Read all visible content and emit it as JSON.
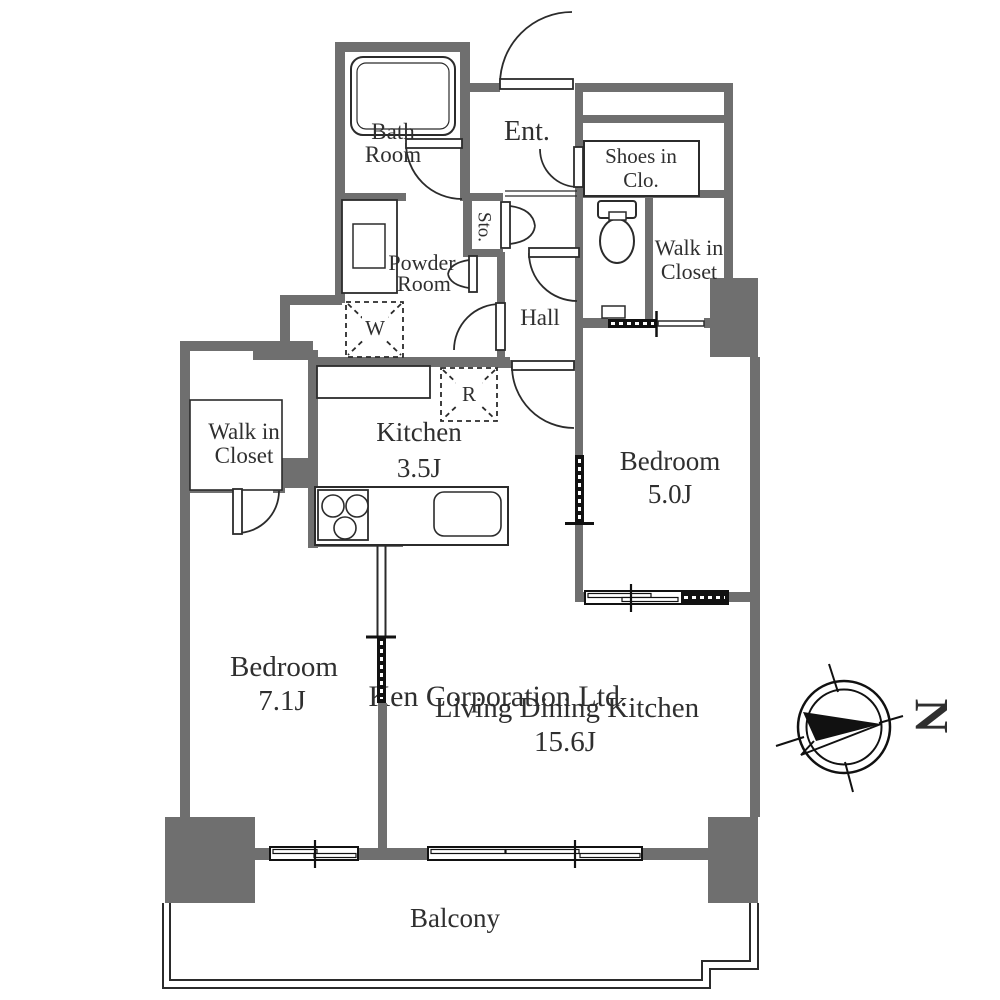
{
  "floorplan": {
    "rooms": {
      "bath": {
        "line1": "Bath",
        "line2": "Room"
      },
      "entrance": {
        "label": "Ent."
      },
      "shoes_closet": {
        "line1": "Shoes in",
        "line2": "Clo."
      },
      "storage": {
        "label": "Sto."
      },
      "powder": {
        "line1": "Powder",
        "line2": "Room"
      },
      "walk_in_closet_right": {
        "line1": "Walk in",
        "line2": "Closet"
      },
      "hall": {
        "label": "Hall"
      },
      "washer_space": {
        "label": "W"
      },
      "refrigerator_space": {
        "label": "R"
      },
      "kitchen": {
        "name": "Kitchen",
        "size": "3.5J"
      },
      "bedroom_right": {
        "name": "Bedroom",
        "size": "5.0J"
      },
      "walk_in_closet_left": {
        "line1": "Walk in",
        "line2": "Closet"
      },
      "bedroom_left": {
        "name": "Bedroom",
        "size": "7.1J"
      },
      "ldk": {
        "name": "Living Dining Kitchen",
        "size": "15.6J"
      },
      "balcony": {
        "label": "Balcony"
      }
    },
    "compass": {
      "north_label": "N"
    },
    "watermark": "Ken Corporation Ltd.",
    "colors": {
      "wall": "#6f6f6f",
      "line": "#2b2b2b",
      "watermark": "#d9d9d9"
    }
  }
}
